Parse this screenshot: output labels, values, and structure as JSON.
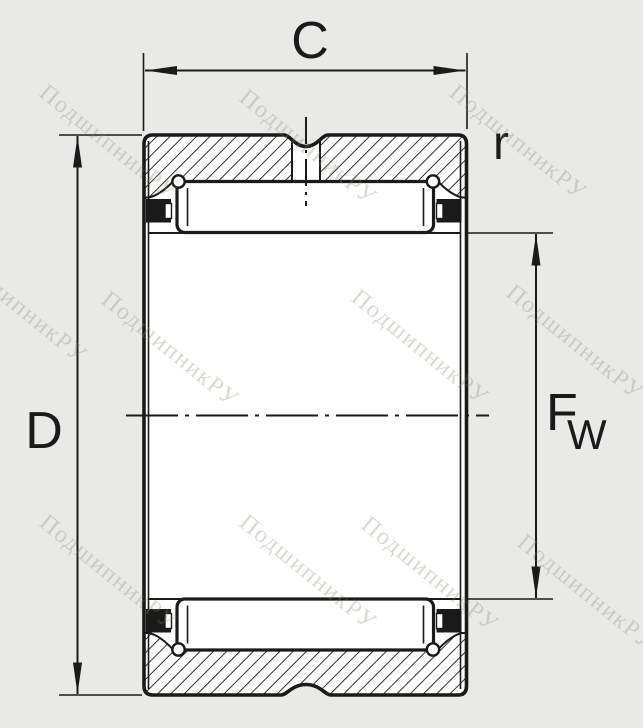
{
  "labels": {
    "width": "C",
    "outer_diameter": "D",
    "chamfer_radius": "r",
    "bore_diameter_main": "F",
    "bore_diameter_sub": "W"
  },
  "watermark": {
    "text": "ПодшипникРУ"
  },
  "colors": {
    "background": "#e9e9e8",
    "line": "#1a1a1a",
    "surface": "#ffffff",
    "watermark": "#8b8270"
  }
}
